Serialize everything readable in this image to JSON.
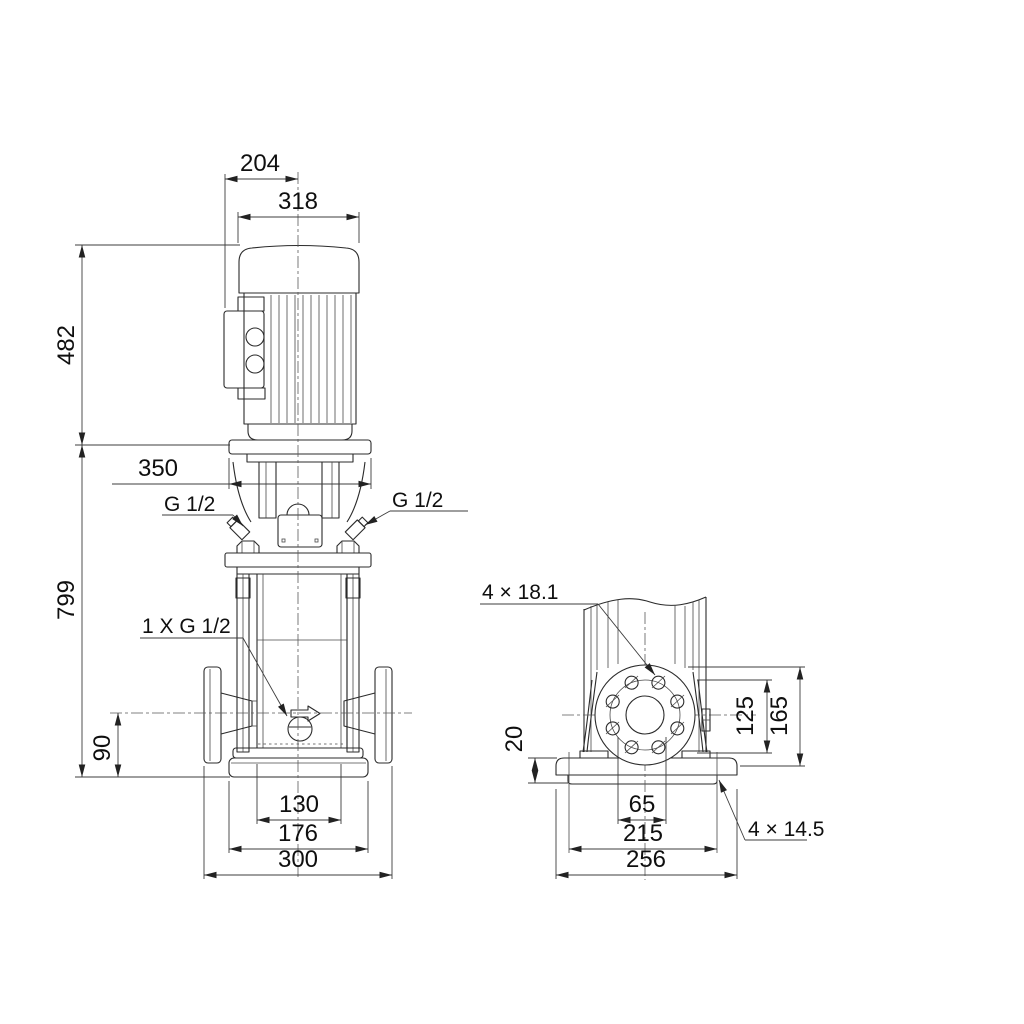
{
  "drawing": {
    "type": "technical-dimensional-drawing",
    "line_color": "#2b2b2b",
    "background": "#ffffff",
    "views": {
      "front": {
        "dimensions": {
          "motor_face_to_center": "204",
          "motor_width": "318",
          "motor_height": "482",
          "head_width": "350",
          "pump_height": "799",
          "port_center_height": "90",
          "foot_inner_width": "130",
          "foot_width": "176",
          "port_to_port": "300"
        },
        "labels": {
          "vent_left": "G 1/2",
          "vent_right": "G 1/2",
          "drain": "1 X G 1/2"
        }
      },
      "side": {
        "dimensions": {
          "base_thickness": "20",
          "flange_bolt_height": "125",
          "flange_top_height": "165",
          "port_bore": "65",
          "base_hole_spacing": "215",
          "base_width": "256"
        },
        "labels": {
          "flange_holes": "4 × 18.1",
          "base_holes": "4 × 14.5"
        }
      }
    }
  }
}
